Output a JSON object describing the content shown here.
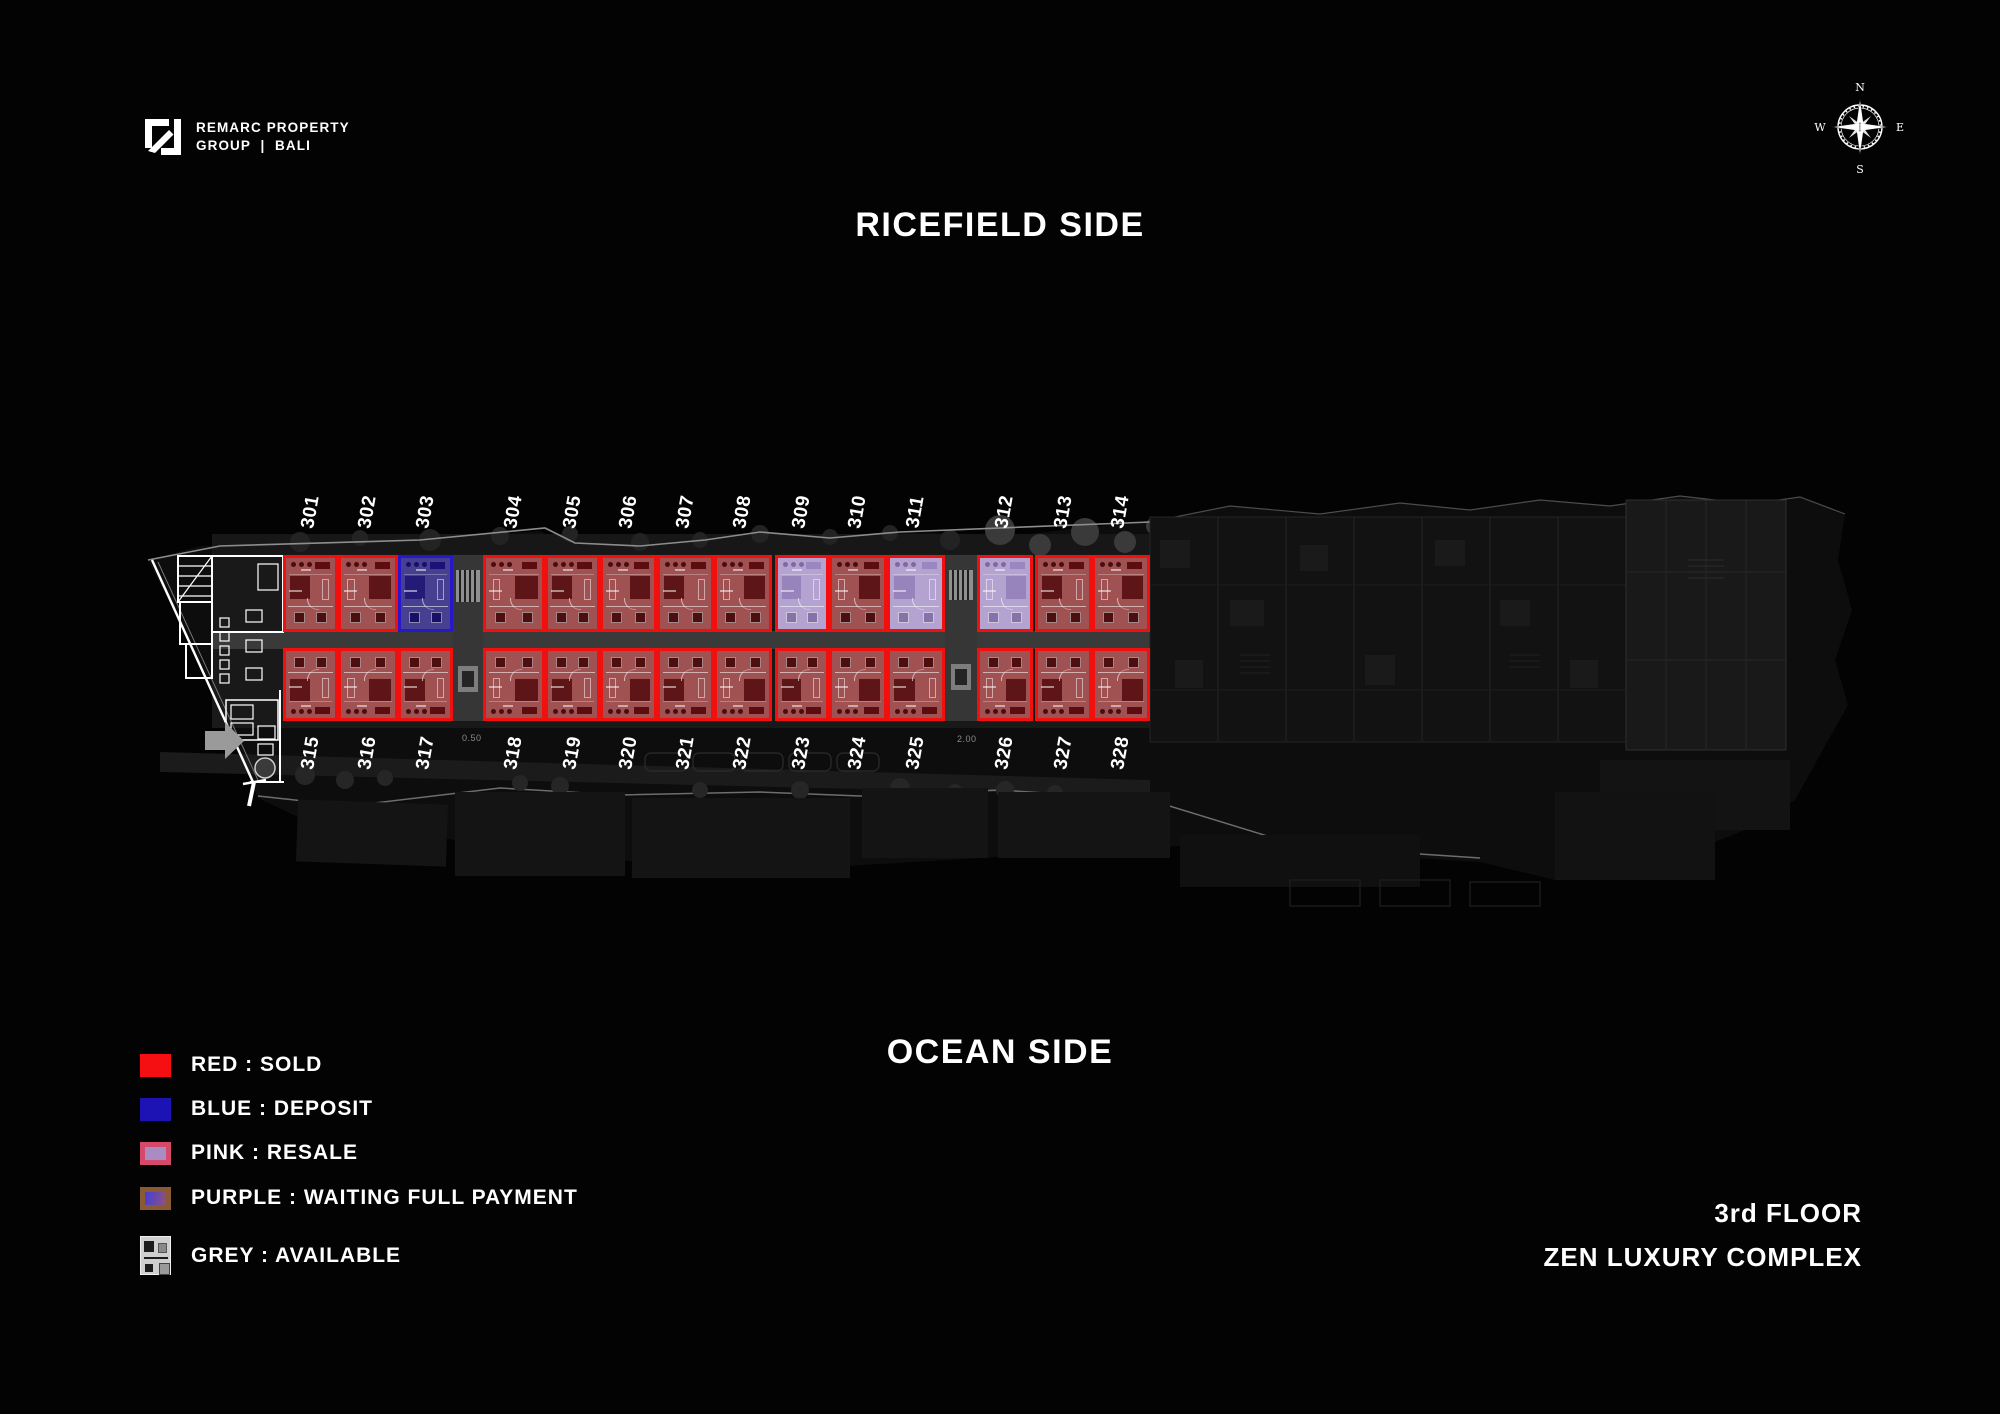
{
  "header": {
    "brand_line1": "REMARC PROPERTY",
    "brand_line2": "GROUP  |  BALI",
    "compass": {
      "n": "N",
      "e": "E",
      "s": "S",
      "w": "W"
    }
  },
  "titles": {
    "top_side": "RICEFIELD SIDE",
    "bottom_side": "OCEAN SIDE",
    "floor": "3rd FLOOR",
    "complex": "ZEN LUXURY COMPLEX"
  },
  "legend": [
    {
      "key": "sold",
      "label": "RED : SOLD"
    },
    {
      "key": "deposit",
      "label": "BLUE : DEPOSIT"
    },
    {
      "key": "resale",
      "label": "PINK : RESALE"
    },
    {
      "key": "waiting",
      "label": "PURPLE : WAITING FULL PAYMENT"
    },
    {
      "key": "available",
      "label": "GREY : AVAILABLE"
    }
  ],
  "colors": {
    "sold_border": "#f2100f",
    "sold_fill": "#a05152",
    "deposit_border": "#2619cd",
    "deposit_fill": "#474090",
    "resale_fill": "#b4a3d0",
    "waiting_border": "#8a5a35",
    "background": "#030303",
    "text": "#ffffff"
  },
  "plan": {
    "dim_labels": [
      {
        "text": "0.50",
        "x": 462,
        "y": 733
      },
      {
        "text": "2.00",
        "x": 957,
        "y": 734
      }
    ],
    "units": [
      {
        "number": "301",
        "row": "top",
        "x": 283,
        "w": 55,
        "status": "sold"
      },
      {
        "number": "302",
        "row": "top",
        "x": 338,
        "w": 60,
        "status": "sold"
      },
      {
        "number": "303",
        "row": "top",
        "x": 398,
        "w": 55,
        "status": "deposit"
      },
      {
        "number": "304",
        "row": "top",
        "x": 483,
        "w": 62,
        "status": "sold"
      },
      {
        "number": "305",
        "row": "top",
        "x": 545,
        "w": 55,
        "status": "sold"
      },
      {
        "number": "306",
        "row": "top",
        "x": 600,
        "w": 57,
        "status": "sold"
      },
      {
        "number": "307",
        "row": "top",
        "x": 657,
        "w": 57,
        "status": "sold"
      },
      {
        "number": "308",
        "row": "top",
        "x": 714,
        "w": 58,
        "status": "sold"
      },
      {
        "number": "309",
        "row": "top",
        "x": 775,
        "w": 54,
        "status": "resale"
      },
      {
        "number": "310",
        "row": "top",
        "x": 829,
        "w": 58,
        "status": "sold"
      },
      {
        "number": "311",
        "row": "top",
        "x": 887,
        "w": 58,
        "status": "resale"
      },
      {
        "number": "312",
        "row": "top",
        "x": 977,
        "w": 56,
        "status": "resale"
      },
      {
        "number": "313",
        "row": "top",
        "x": 1035,
        "w": 57,
        "status": "sold"
      },
      {
        "number": "314",
        "row": "top",
        "x": 1092,
        "w": 58,
        "status": "sold"
      },
      {
        "number": "315",
        "row": "bottom",
        "x": 283,
        "w": 55,
        "status": "sold"
      },
      {
        "number": "316",
        "row": "bottom",
        "x": 338,
        "w": 60,
        "status": "sold"
      },
      {
        "number": "317",
        "row": "bottom",
        "x": 398,
        "w": 55,
        "status": "sold"
      },
      {
        "number": "318",
        "row": "bottom",
        "x": 483,
        "w": 62,
        "status": "sold"
      },
      {
        "number": "319",
        "row": "bottom",
        "x": 545,
        "w": 55,
        "status": "sold"
      },
      {
        "number": "320",
        "row": "bottom",
        "x": 600,
        "w": 57,
        "status": "sold"
      },
      {
        "number": "321",
        "row": "bottom",
        "x": 657,
        "w": 57,
        "status": "sold"
      },
      {
        "number": "322",
        "row": "bottom",
        "x": 714,
        "w": 58,
        "status": "sold"
      },
      {
        "number": "323",
        "row": "bottom",
        "x": 775,
        "w": 54,
        "status": "sold"
      },
      {
        "number": "324",
        "row": "bottom",
        "x": 829,
        "w": 58,
        "status": "sold"
      },
      {
        "number": "325",
        "row": "bottom",
        "x": 887,
        "w": 58,
        "status": "sold"
      },
      {
        "number": "326",
        "row": "bottom",
        "x": 977,
        "w": 56,
        "status": "sold"
      },
      {
        "number": "327",
        "row": "bottom",
        "x": 1035,
        "w": 57,
        "status": "sold"
      },
      {
        "number": "328",
        "row": "bottom",
        "x": 1092,
        "w": 58,
        "status": "sold"
      }
    ]
  }
}
